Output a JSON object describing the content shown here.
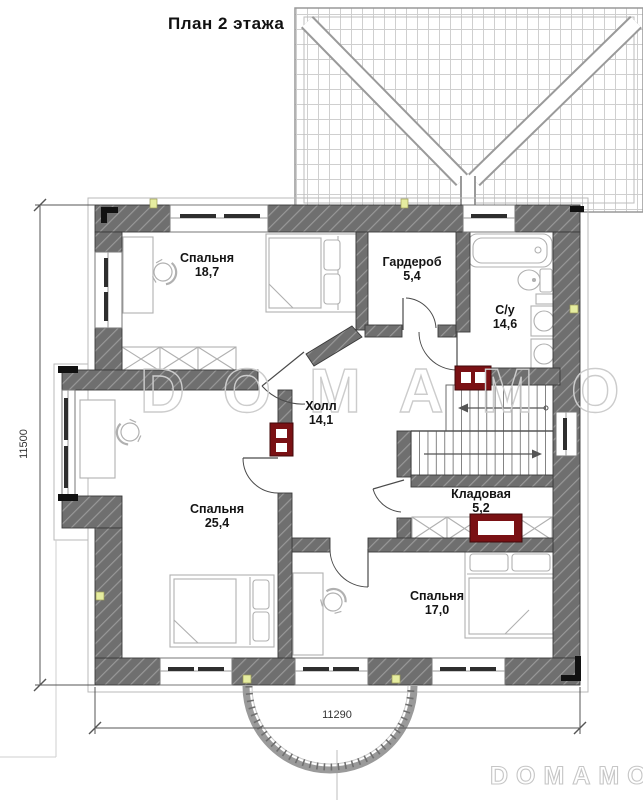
{
  "title": "План 2 этажа",
  "rooms": {
    "bedroom1": {
      "name": "Спальня",
      "area": "18,7"
    },
    "wardrobe": {
      "name": "Гардероб",
      "area": "5,4"
    },
    "bathroom": {
      "name": "С/у",
      "area": "14,6"
    },
    "hall": {
      "name": "Холл",
      "area": "14,1"
    },
    "bedroom2": {
      "name": "Спальня",
      "area": "25,4"
    },
    "storage": {
      "name": "Кладовая",
      "area": "5,2"
    },
    "bedroom3": {
      "name": "Спальня",
      "area": "17,0"
    }
  },
  "dimensions": {
    "left": "11500",
    "bottom": "11290"
  },
  "watermarks": {
    "center": "DOMAMO",
    "corner": "DOMAMO"
  },
  "colors": {
    "wall": "#6f6f6f",
    "hatch_line": "#989898",
    "radiator": "#7a1114",
    "furniture_stroke": "#b0b0b0",
    "roof_line": "#c9c9c9",
    "marker_yellow": "#e6eda0"
  }
}
